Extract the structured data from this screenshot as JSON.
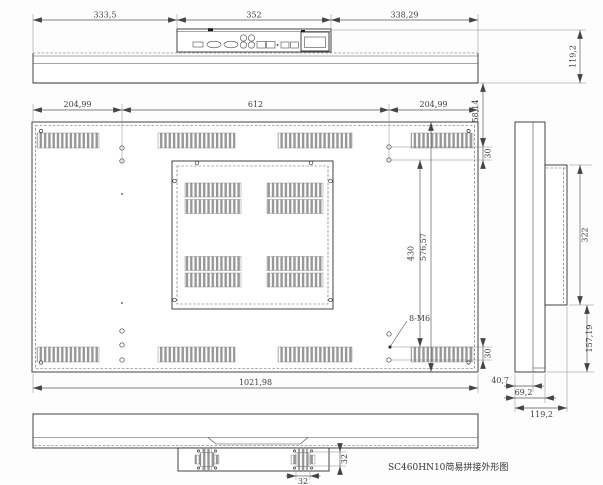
{
  "drawing": {
    "title": "SC460HN10简易拼接外形图",
    "note_thread": "8-M6",
    "dims": {
      "top_left": "333,5",
      "top_mid": "352",
      "top_right": "338,29",
      "depth_total": "119,2",
      "edge_to_hole": "58,14",
      "side_margin": "204,99",
      "hole_span_h": "612",
      "hole_gap": "30",
      "hole_span_v": "430",
      "height_total": "576,57",
      "width_total": "1021,98",
      "recess_height": "322",
      "lower_height": "157,19",
      "front_depth": "40,7",
      "mid_depth": "69,2",
      "speaker_size": "32"
    }
  }
}
